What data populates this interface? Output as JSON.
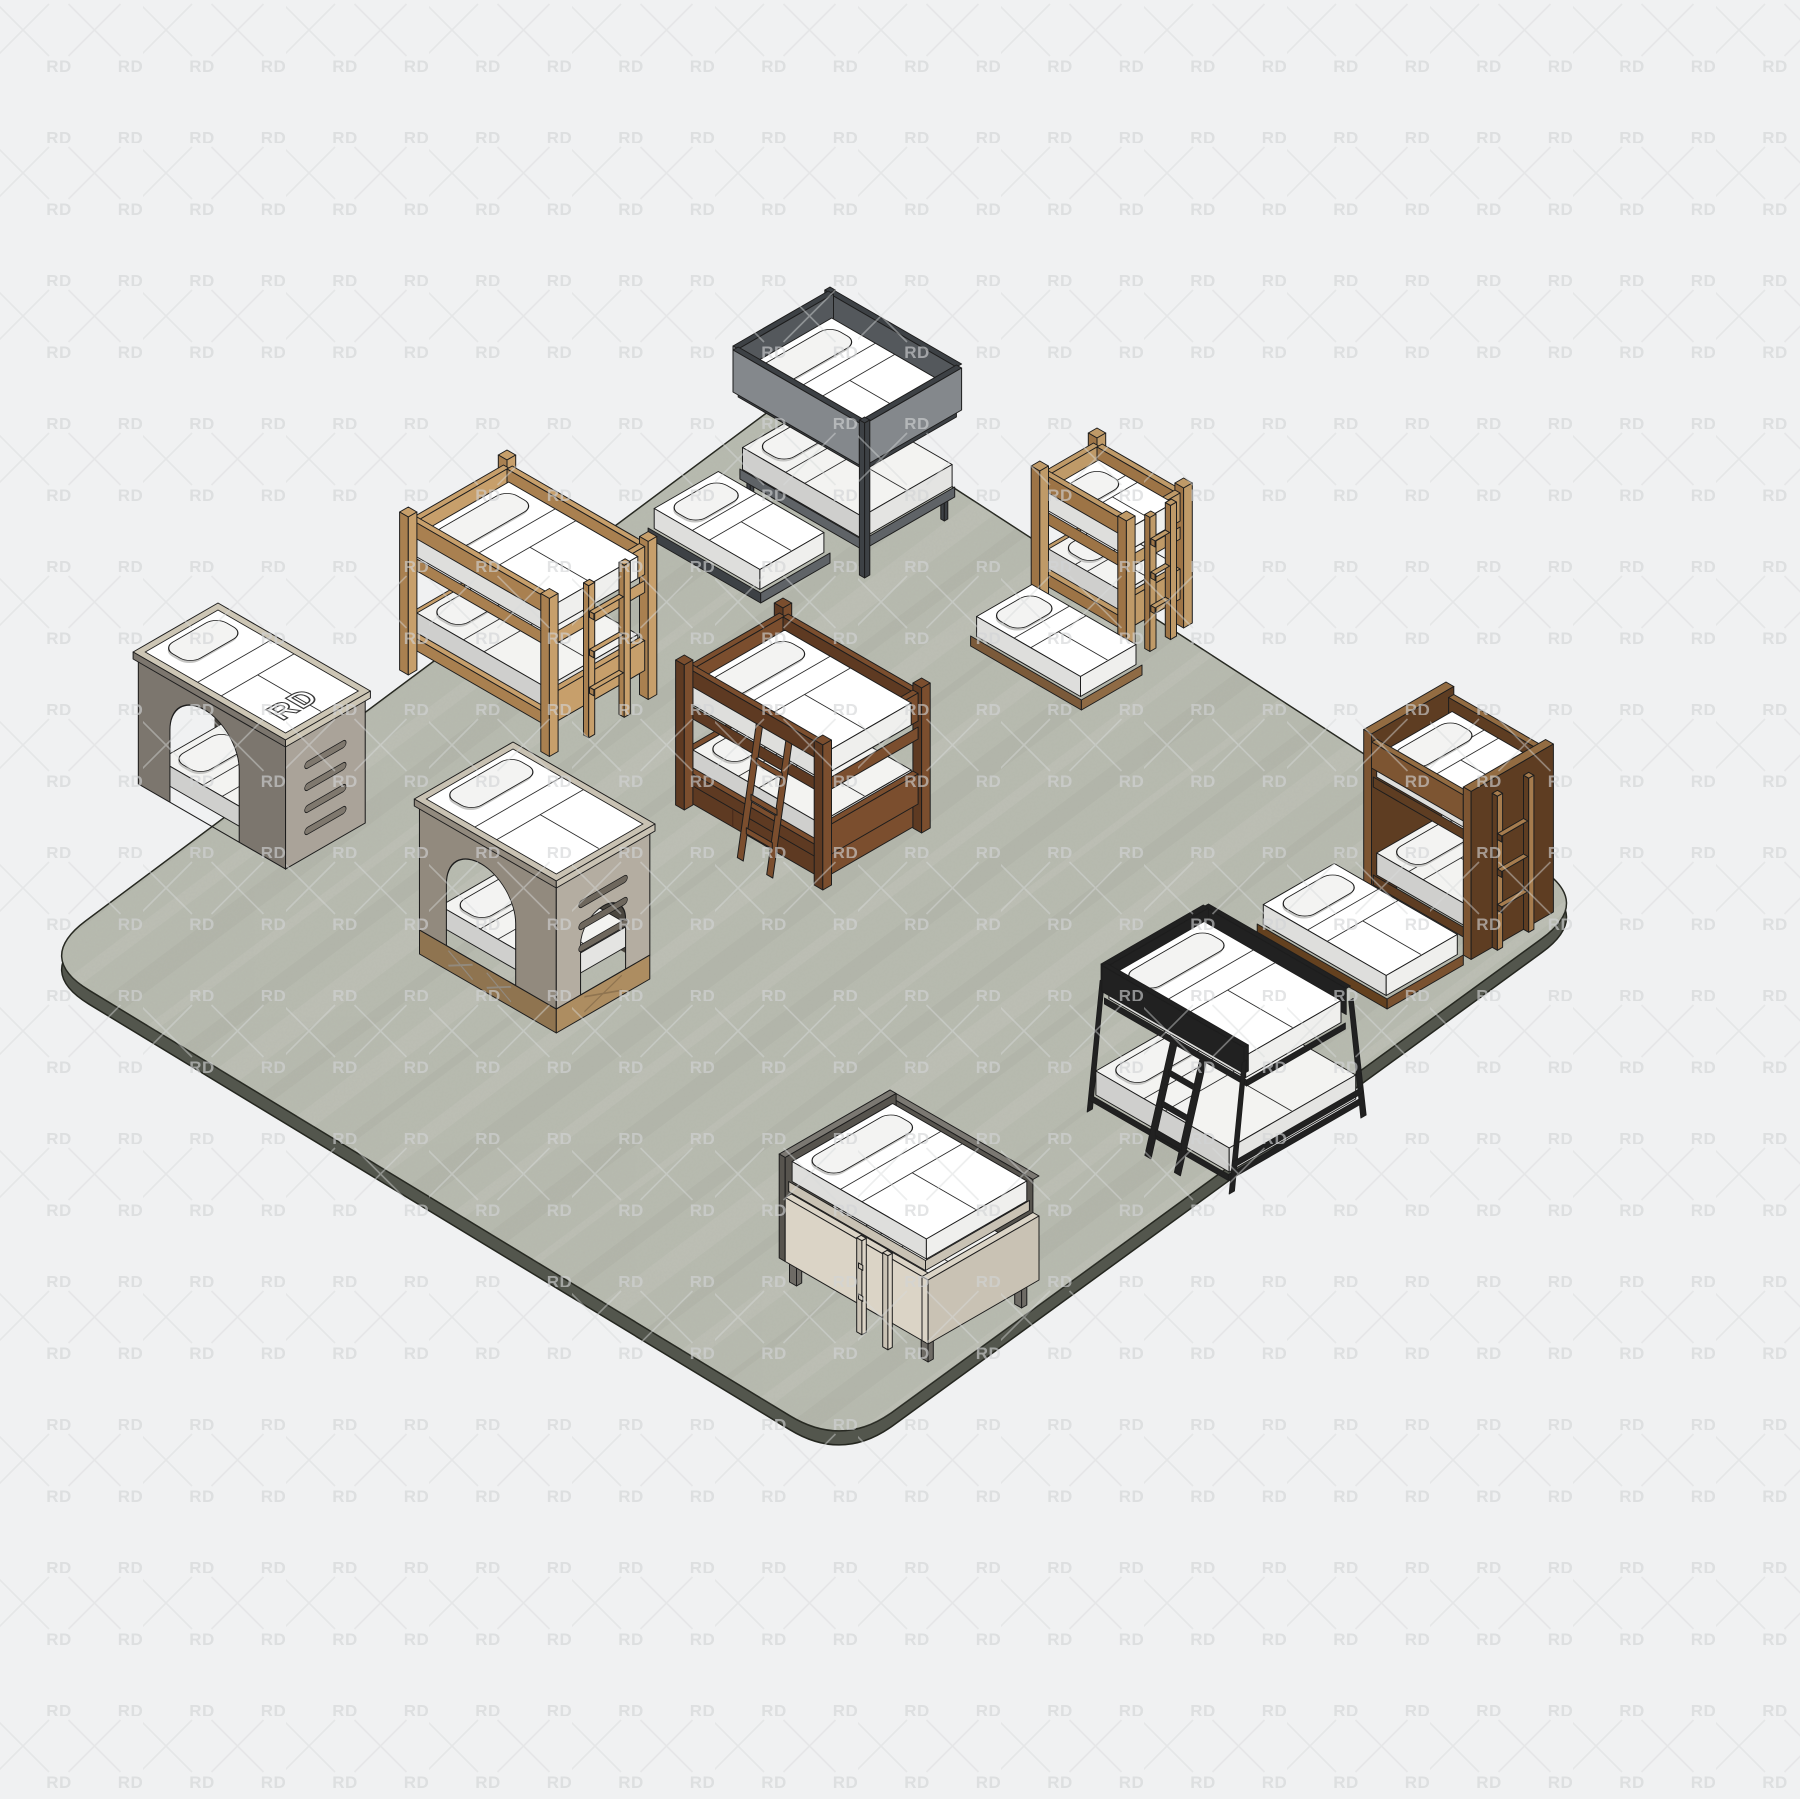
{
  "scene": {
    "description": "isometric-3d-render-of-nine-bunk-bed-models-on-concrete-slab",
    "background_color": "#f0f1f2",
    "watermark": {
      "text": "RD",
      "text_color": "#d2d3d5",
      "line_color": "#d8d9da"
    },
    "platform": {
      "top_color": "#b8bbb0",
      "side_color": "#53564d",
      "outline_color": "#24261f",
      "streak_light": "#ffffff",
      "streak_dark": "#5b5e52"
    },
    "mattress": {
      "top": "#ffffff",
      "side_left": "#dededc",
      "side_right": "#efefed",
      "low_top": "#f3f3f1",
      "low_side_left": "#cfcfcd",
      "low_side_right": "#e4e4e2",
      "pillow": "#f3f3f2",
      "pillow_shadow": "#c6c6c4",
      "seam": "#2b2b2b",
      "outline": "#1d1d1d"
    }
  },
  "beds": [
    {
      "id": "gray-house-bunk-rd-logo",
      "label": "RD",
      "colors": {
        "wall_left": "#7c766e",
        "wall_right": "#aaa399",
        "rim": "#cdc6b5",
        "interior": "#45423c",
        "slot": "#7f786e"
      }
    },
    {
      "id": "pine-frame-bunk-with-ladder",
      "colors": {
        "light": "#c79f6b",
        "mid": "#a98050",
        "dark": "#8a6540"
      }
    },
    {
      "id": "gray-steel-bunk-with-trundle",
      "colors": {
        "frame": "#3d4145",
        "panel_out": "#84888c",
        "panel_in": "#54585c",
        "panel_top": "#96999d",
        "base": "#5f6367"
      }
    },
    {
      "id": "oak-bunk-with-ladder-and-trundle",
      "colors": {
        "light": "#bf9a68",
        "mid": "#9d7446",
        "dark": "#7d5a38",
        "trundle_l": "#7b5a3a",
        "trundle_r": "#8f6b45"
      }
    },
    {
      "id": "walnut-panel-bunk-with-trundle",
      "colors": {
        "face": "#7d5532",
        "side": "#5e3d22",
        "top": "#936c42",
        "light": "#a67c4e",
        "trundle_l": "#64411f",
        "trundle_r": "#7a5230"
      }
    },
    {
      "id": "espresso-storage-bunk-angled-ladder",
      "colors": {
        "light": "#7b4e2e",
        "mid": "#5e3a22",
        "dark": "#46291a"
      }
    },
    {
      "id": "black-steel-twin-over-full-bunk",
      "colors": {
        "frame": "#212121",
        "hi": "#3a3a3a"
      }
    },
    {
      "id": "taupe-arch-house-bunk",
      "colors": {
        "wall_left": "#928a7e",
        "wall_right": "#b4ada1",
        "rim": "#c9c2b3",
        "interior": "#4a463f",
        "base_l": "#8f7450",
        "base_r": "#ad8d61",
        "slot": "#6e675d"
      }
    },
    {
      "id": "greige-two-tone-low-bunk",
      "colors": {
        "back_top": "#7b7872",
        "back_in": "#57544e",
        "front": "#dbd4c6",
        "front_side": "#c9c2b4",
        "leg": "#6e6b65"
      }
    }
  ]
}
